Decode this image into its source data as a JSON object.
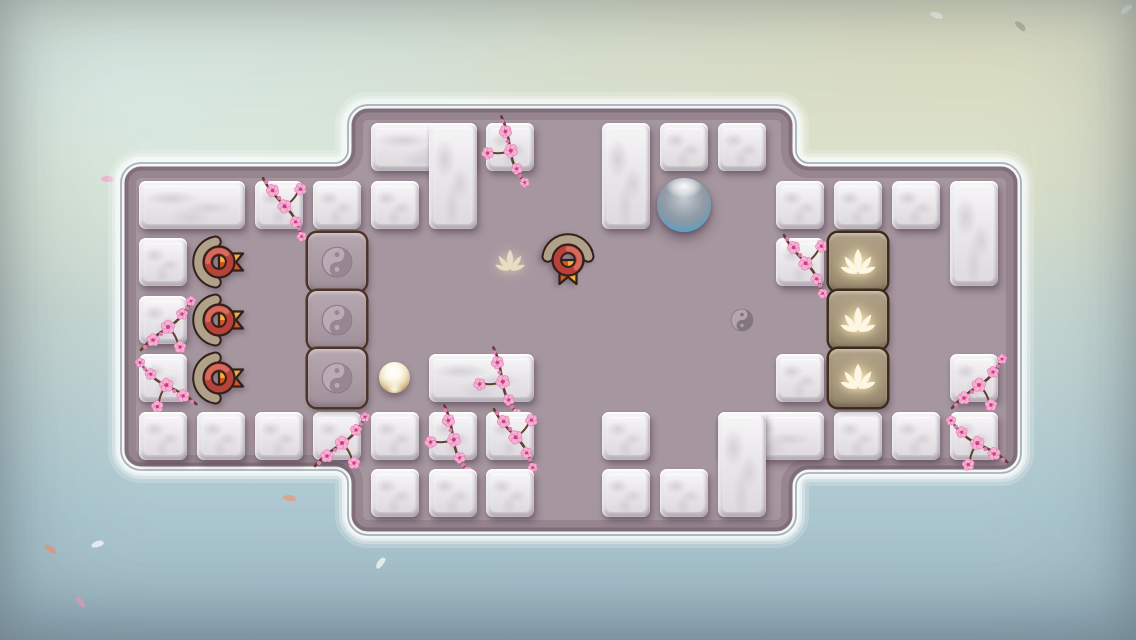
{
  "window": {
    "width": 1136,
    "height": 640,
    "visible_text": "none"
  },
  "game": {
    "grid": {
      "origin_x": 139,
      "origin_y": 123,
      "pitch_x": 57.9,
      "pitch_y": 57.7,
      "tile_size": 48
    },
    "board": {
      "floor_color": "#a6969f",
      "outline": {
        "left_wing": {
          "x1": 121,
          "y1": 163,
          "x2": 348,
          "y2": 470
        },
        "middle": {
          "x1": 348,
          "y1": 105,
          "x2": 796,
          "y2": 535
        },
        "right_wing": {
          "x1": 796,
          "y1": 163,
          "x2": 1021,
          "y2": 473
        }
      }
    },
    "marble_blocks": [
      {
        "c": 4,
        "r": 0,
        "w": 2
      },
      {
        "c": 5,
        "r": 0,
        "h": 2
      },
      {
        "c": 6,
        "r": 0,
        "blossom": true
      },
      {
        "c": 8,
        "r": 0,
        "h": 2
      },
      {
        "c": 9,
        "r": 0
      },
      {
        "c": 10,
        "r": 0
      },
      {
        "c": 0,
        "r": 1,
        "w": 2
      },
      {
        "c": 2,
        "r": 1,
        "blossom": true
      },
      {
        "c": 3,
        "r": 1
      },
      {
        "c": 4,
        "r": 1
      },
      {
        "c": 11,
        "r": 1
      },
      {
        "c": 12,
        "r": 1
      },
      {
        "c": 13,
        "r": 1
      },
      {
        "c": 14,
        "r": 1,
        "h": 2
      },
      {
        "c": 0,
        "r": 2
      },
      {
        "c": 11,
        "r": 2,
        "blossom": true
      },
      {
        "c": 0,
        "r": 3,
        "blossom": true
      },
      {
        "c": 0,
        "r": 4,
        "blossom": true
      },
      {
        "c": 5,
        "r": 4,
        "w": 2,
        "blossom": true
      },
      {
        "c": 11,
        "r": 4
      },
      {
        "c": 14,
        "r": 4,
        "blossom": true
      },
      {
        "c": 0,
        "r": 5
      },
      {
        "c": 1,
        "r": 5
      },
      {
        "c": 2,
        "r": 5
      },
      {
        "c": 3,
        "r": 5,
        "blossom": true
      },
      {
        "c": 4,
        "r": 5
      },
      {
        "c": 5,
        "r": 5,
        "blossom": true
      },
      {
        "c": 6,
        "r": 5,
        "blossom": true
      },
      {
        "c": 8,
        "r": 5
      },
      {
        "c": 10,
        "r": 5,
        "w": 2
      },
      {
        "c": 10,
        "r": 5,
        "h": 2
      },
      {
        "c": 12,
        "r": 5
      },
      {
        "c": 13,
        "r": 5
      },
      {
        "c": 14,
        "r": 5,
        "blossom": true
      },
      {
        "c": 4,
        "r": 6
      },
      {
        "c": 5,
        "r": 6
      },
      {
        "c": 6,
        "r": 6
      },
      {
        "c": 8,
        "r": 6
      },
      {
        "c": 9,
        "r": 6
      }
    ],
    "special_tiles": [
      {
        "c": 3,
        "r": 2,
        "type": "yinyang"
      },
      {
        "c": 3,
        "r": 3,
        "type": "yinyang"
      },
      {
        "c": 3,
        "r": 4,
        "type": "yinyang"
      },
      {
        "c": 12,
        "r": 2,
        "type": "lotus"
      },
      {
        "c": 12,
        "r": 3,
        "type": "lotus"
      },
      {
        "c": 12,
        "r": 4,
        "type": "lotus"
      }
    ],
    "floor_markers": [
      {
        "c": 1,
        "r": 2,
        "type": "badge",
        "dir": "right"
      },
      {
        "c": 1,
        "r": 3,
        "type": "badge",
        "dir": "right"
      },
      {
        "c": 1,
        "r": 4,
        "type": "badge",
        "dir": "right"
      },
      {
        "c": 7,
        "r": 2,
        "type": "badge",
        "dir": "down"
      },
      {
        "c": 6,
        "r": 2,
        "type": "lotus_ghost"
      },
      {
        "c": 10,
        "r": 3,
        "type": "yinyang_ghost"
      }
    ],
    "orbs": [
      {
        "c": 9,
        "r": 1,
        "type": "player_orb"
      },
      {
        "c": 4,
        "r": 4,
        "type": "pearl"
      }
    ],
    "background": {
      "petals": [
        {
          "x": 44,
          "y": 546,
          "hue": "salmon",
          "rot": 38
        },
        {
          "x": 91,
          "y": 541,
          "hue": "white",
          "rot": -15
        },
        {
          "x": 283,
          "y": 495,
          "hue": "salmon",
          "rot": 12
        },
        {
          "x": 495,
          "y": 464,
          "hue": "salmon",
          "rot": 28
        },
        {
          "x": 1014,
          "y": 23,
          "hue": "gray",
          "rot": 45
        },
        {
          "x": 1120,
          "y": 6,
          "hue": "white",
          "rot": -35
        },
        {
          "x": 101,
          "y": 176,
          "hue": "pink",
          "rot": 8
        },
        {
          "x": 374,
          "y": 560,
          "hue": "white",
          "rot": -50
        },
        {
          "x": 74,
          "y": 599,
          "hue": "pink",
          "rot": 55
        },
        {
          "x": 930,
          "y": 12,
          "hue": "white",
          "rot": 20
        }
      ]
    },
    "colors": {
      "floor": "#a6969f",
      "board_line": "#a9b2b6",
      "board_glow": "#ffffff",
      "marble_face": "#eae7ea",
      "yinyang_tile": "#ab9ba5",
      "yinyang_border": "#4c3526",
      "yy_light": "#bcabb4",
      "yy_dark": "#978794",
      "lotus_tile": "#a29378",
      "lotus_border": "#3c2a1b",
      "lotus_icon": "#fdf6e2",
      "badge_red": "#b8423a",
      "badge_red_hi": "#d96f60",
      "badge_outline": "#31211a",
      "badge_arc": "#b2a18a",
      "ribbon_top": "#eeb23e",
      "ribbon_bottom": "#d4571f",
      "orb_rim": "#1c5472",
      "orb_blue": "#5fb0d8",
      "orb_body": "#99a2ac",
      "pearl_rim": "#8f794c",
      "branch": "#5f4130",
      "petal_pink": "#f6b0d2",
      "petal_edge": "#e27db2",
      "flower_center": "#c93f85",
      "ghost_lotus": "rgba(253,242,205,0.9)",
      "ghost_yy_dark": "rgba(120,105,115,0.9)",
      "ghost_yy_light": "rgba(186,173,181,0.8)",
      "petal_hues": {
        "salmon": "rgba(233,156,128,0.8)",
        "white": "rgba(255,255,255,0.75)",
        "pink": "rgba(242,173,200,0.8)",
        "gray": "rgba(158,158,146,0.6)"
      }
    }
  }
}
